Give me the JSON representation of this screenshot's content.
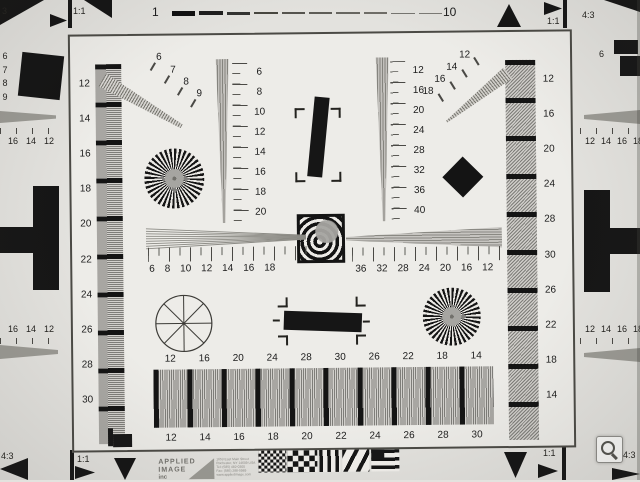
{
  "colors": {
    "paper": "#edece8",
    "outer": "#e3e2de",
    "ink": "#1b1b1b",
    "pattern_gray": "#94938e",
    "logo_gray": "#73726d"
  },
  "icons": {
    "magnifier": "magnifying-glass"
  },
  "top_scale": {
    "start": "1",
    "end": "10"
  },
  "registration": {
    "top_left": "1:1",
    "top_right": "1:1",
    "bottom_left": "1:1",
    "bottom_right": "1:1"
  },
  "neighbors": {
    "top_left_partial": "3",
    "top_right_ratio": "4:3",
    "bottom_left_ratio": "4:3",
    "bottom_right_ratio": "4:3",
    "top_right_wedge_label": "6",
    "left_edge": {
      "square_labels": [
        "6",
        "7",
        "8",
        "9"
      ],
      "top_labels": [
        "18",
        "16",
        "14",
        "12"
      ],
      "bottom_labels": [
        "18",
        "16",
        "14",
        "12"
      ]
    },
    "right_edge": {
      "top_labels": [
        "12",
        "14",
        "16",
        "18"
      ],
      "bottom_labels": [
        "12",
        "14",
        "16",
        "18"
      ]
    }
  },
  "left_column_labels": [
    "12",
    "14",
    "16",
    "18",
    "20",
    "22",
    "24",
    "26",
    "28",
    "30"
  ],
  "right_column_labels": [
    "12",
    "16",
    "20",
    "24",
    "28",
    "30",
    "26",
    "22",
    "18",
    "14"
  ],
  "diagonal_wedge_tl_labels": [
    "6",
    "7",
    "8",
    "9"
  ],
  "diagonal_wedge_tr_labels": [
    "18",
    "16",
    "14",
    "12"
  ],
  "vertical_wedge_left_labels": [
    "6",
    "8",
    "10",
    "12",
    "14",
    "16",
    "18",
    "20"
  ],
  "vertical_wedge_right_labels": [
    "12",
    "16",
    "20",
    "24",
    "28",
    "32",
    "36",
    "40"
  ],
  "horizontal_sweep_left_labels": [
    "6",
    "8",
    "10",
    "12",
    "14",
    "16",
    "18"
  ],
  "horizontal_wedge_right_labels": [
    "36",
    "32",
    "28",
    "24",
    "20",
    "16",
    "12"
  ],
  "bottom_row": {
    "top_labels": [
      "12",
      "16",
      "20",
      "24",
      "28",
      "30",
      "26",
      "22",
      "18",
      "14"
    ],
    "bottom_labels": [
      "12",
      "14",
      "16",
      "18",
      "20",
      "22",
      "24",
      "26",
      "28",
      "30"
    ]
  },
  "logo": {
    "name_line1": "APPLIED",
    "name_line2": "IMAGE",
    "name_line3": "inc",
    "address_lines": [
      "1653 East Main Street",
      "Rochester, NY 14609 USA",
      "Tel: (585) 482-0300",
      "Fax: (585) 288-5989",
      "www.appliedimage.com"
    ]
  }
}
